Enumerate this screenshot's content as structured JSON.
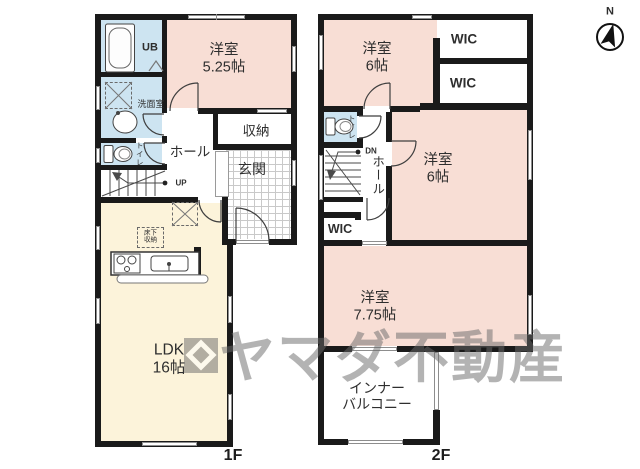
{
  "colors": {
    "wall": "#1a1a1a",
    "room_pink": "#f8ded5",
    "room_blue": "#cde4f1",
    "room_cream": "#fcf3da",
    "line": "#3f3f3f",
    "watermark": "#6a6a6a"
  },
  "compass": {
    "label": "N"
  },
  "watermark": {
    "text": "ヤマダ不動産",
    "logo_icon": "yamada-diamond-logo"
  },
  "floor1": {
    "label": "1F",
    "rooms": {
      "bedroom": {
        "name": "洋室",
        "size": "5.25帖"
      },
      "ub": {
        "name": "UB"
      },
      "washroom": {
        "name": "洗面室"
      },
      "toilet": {
        "name": "トイレ"
      },
      "hall": {
        "name": "ホール"
      },
      "closet": {
        "name": "収納"
      },
      "genkan": {
        "name": "玄関"
      },
      "ldk": {
        "name": "LDK",
        "size": "16帖"
      },
      "underfloor_storage": {
        "name_line1": "床下",
        "name_line2": "収納"
      },
      "stairs": {
        "direction": "UP"
      }
    }
  },
  "floor2": {
    "label": "2F",
    "rooms": {
      "bedroom1": {
        "name": "洋室",
        "size": "6帖"
      },
      "wic1": {
        "name": "WIC"
      },
      "wic2": {
        "name": "WIC"
      },
      "bedroom2": {
        "name": "洋室",
        "size": "6帖"
      },
      "toilet": {
        "name": "トイレ"
      },
      "hall": {
        "name": "ホール"
      },
      "wic3": {
        "name": "WIC"
      },
      "bedroom3": {
        "name": "洋室",
        "size": "7.75帖"
      },
      "balcony": {
        "name_line1": "インナー",
        "name_line2": "バルコニー"
      },
      "stairs": {
        "direction": "DN"
      }
    }
  }
}
